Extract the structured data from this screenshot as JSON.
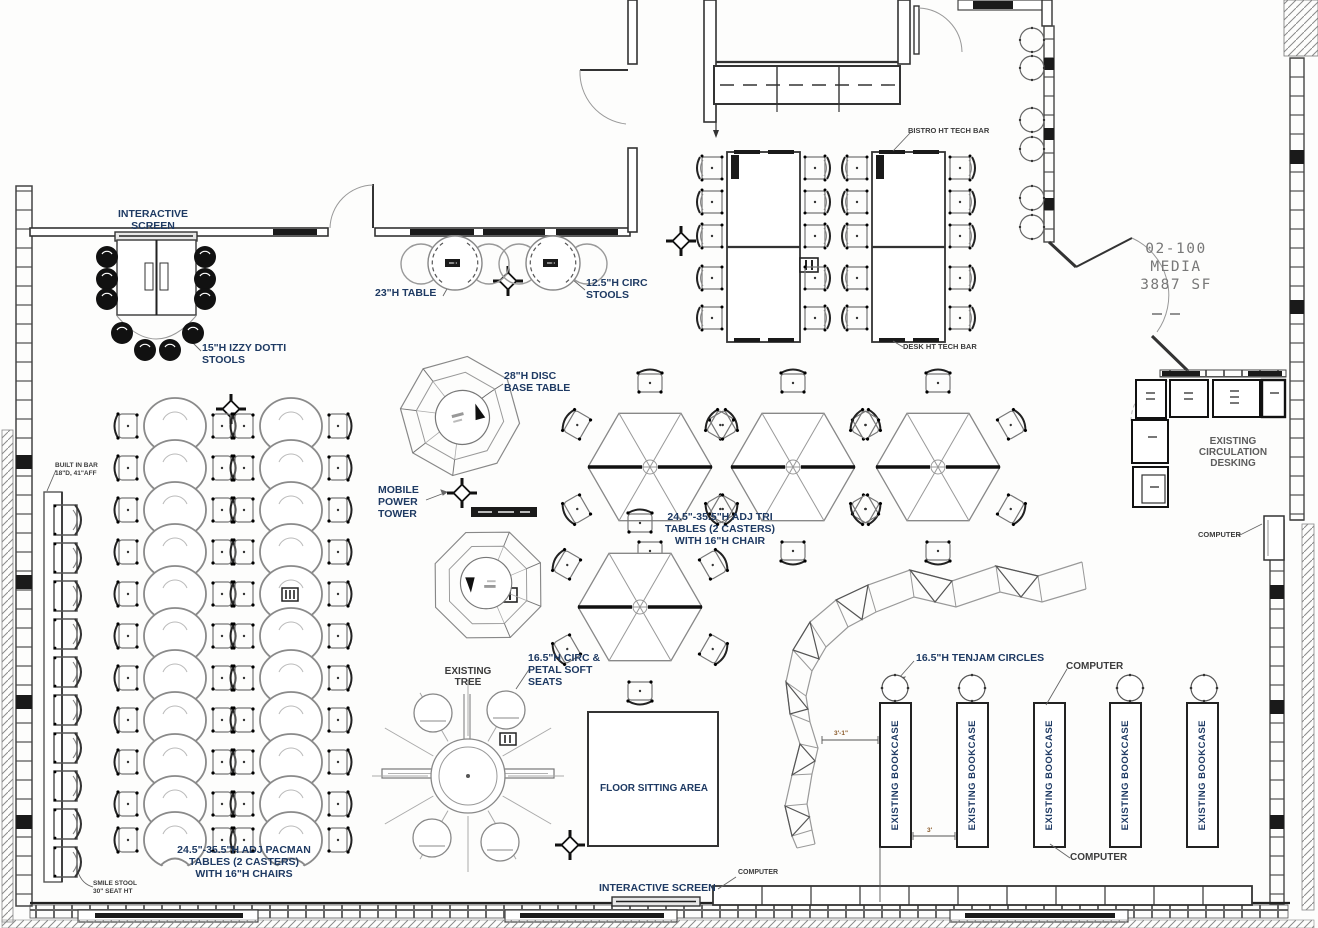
{
  "room": {
    "number": "02-100",
    "name": "MEDIA",
    "area": "3887 SF"
  },
  "labels": {
    "interactive_screen_top": "INTERACTIVE SCREEN",
    "interactive_screen_bottom": "INTERACTIVE SCREEN",
    "table_23h": "23\"H TABLE",
    "circ_stools": "12.5\"H CIRC\nSTOOLS",
    "izzy_dotti_stools": "15\"H IZZY DOTTI\nSTOOLS",
    "disc_base_table": "28\"H DISC\nBASE TABLE",
    "mobile_power_tower": "MOBILE\nPOWER\nTOWER",
    "bistro_tech_bar": "BISTRO HT TECH BAR",
    "desk_tech_bar": "DESK HT TECH BAR",
    "tri_tables": "24.5\"-35.5\"H ADJ TRI\nTABLES (2 CASTERS)\nWITH 16\"H CHAIR",
    "pacman_tables": "24.5\"-35.5\"H ADJ PACMAN\nTABLES (2 CASTERS)\nWITH 16\"H CHAIRS",
    "built_in_bar": "BUILT IN BAR\n18\"D, 41\"AFF",
    "smile_stool": "SMILE STOOL\n30\" SEAT HT",
    "existing_tree": "EXISTING\nTREE",
    "petal_seats": "16.5\"H CIRC &\nPETAL SOFT\nSEATS",
    "floor_sitting_area": "FLOOR SITTING AREA",
    "tenjam_circles": "16.5\"H TENJAM CIRCLES",
    "circulation_desking": "EXISTING\nCIRCULATION\nDESKING",
    "computer_top": "COMPUTER",
    "computer_bottom": "COMPUTER",
    "computer_bottom_left": "COMPUTER",
    "computer_right": "COMPUTER"
  },
  "bookcases": [
    "EXISTING BOOKCASE",
    "EXISTING BOOKCASE",
    "EXISTING BOOKCASE",
    "EXISTING BOOKCASE",
    "EXISTING BOOKCASE"
  ],
  "dims": {
    "bookcase_gap_left": "3'-1\"",
    "bookcase_gap": "3'"
  },
  "colors": {
    "label_navy": "#1e3a63",
    "line_dark": "#333333",
    "line_gray": "#888888",
    "dim_orange": "#8a5a2a"
  }
}
